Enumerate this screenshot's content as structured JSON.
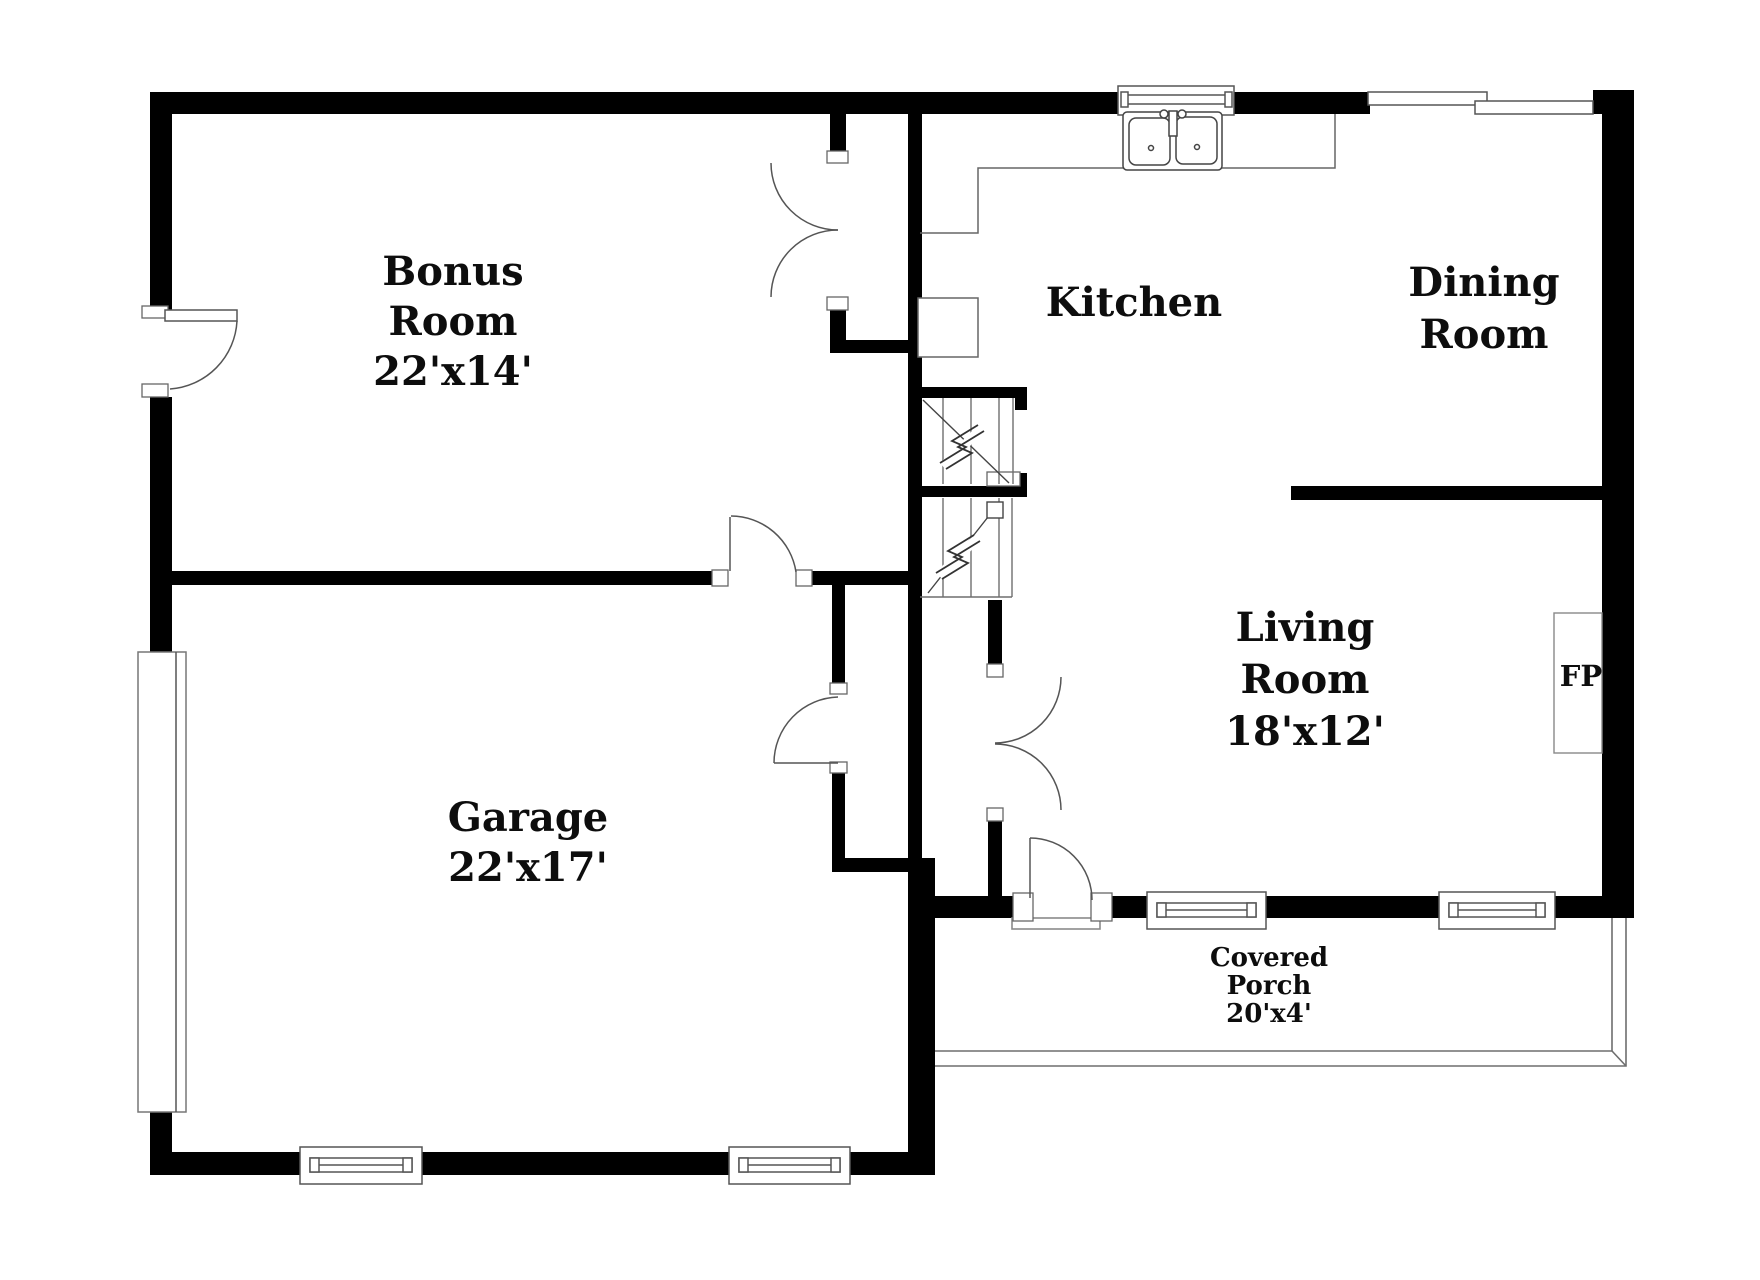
{
  "plan": {
    "type": "residential-floor-plan",
    "colors": {
      "wall": "#000000",
      "thin_line": "#6e6e6e",
      "fixture_line": "#555555",
      "background": "#ffffff",
      "text": "#0d0d0d"
    },
    "rooms": {
      "bonus": {
        "name": "Bonus Room",
        "dims": "22'x14'",
        "lines": [
          "Bonus",
          "Room",
          "22'x14'"
        ]
      },
      "kitchen": {
        "name": "Kitchen",
        "dims": "",
        "lines": [
          "Kitchen"
        ]
      },
      "dining": {
        "name": "Dining Room",
        "dims": "",
        "lines": [
          "Dining",
          "Room"
        ]
      },
      "living": {
        "name": "Living Room",
        "dims": "18'x12'",
        "lines": [
          "Living",
          "Room",
          "18'x12'"
        ]
      },
      "garage": {
        "name": "Garage",
        "dims": "22'x17'",
        "lines": [
          "Garage",
          "22'x17'"
        ]
      },
      "porch": {
        "name": "Covered Porch",
        "dims": "20'x4'",
        "lines": [
          "Covered",
          "Porch",
          "20'x4'"
        ]
      },
      "fireplace": {
        "label": "FP"
      }
    },
    "fixtures": [
      "double-kitchen-sink",
      "kitchen-counter",
      "refrigerator",
      "fireplace",
      "stairs-up",
      "stairs-down",
      "garage-door",
      "double-doors",
      "windows"
    ]
  }
}
